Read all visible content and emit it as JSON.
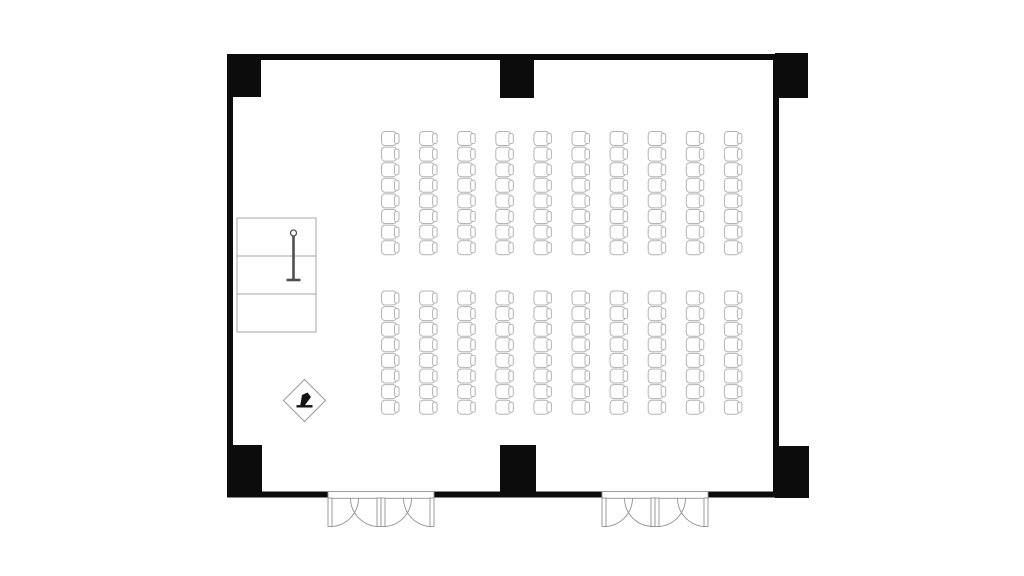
{
  "plan_type": "meeting-room-theater-style-floor-plan",
  "colors": {
    "background": "#ffffff",
    "wall": "#0c0c0c",
    "chair_outline": "#b4b4b4",
    "table_outline": "#a6a6a6",
    "door_outline": "#929292",
    "stand_stroke": "#4f4f4f",
    "symbol_outline": "#9a9a9a",
    "symbol_glyph": "#151515",
    "fill_white": "#ffffff"
  },
  "plan": {
    "room": {
      "x": 227,
      "y": 54,
      "w": 552,
      "h": 443.5,
      "wall_thickness": 6
    },
    "pillars": [
      {
        "id": "pillar-top-left",
        "x": 227,
        "y": 54,
        "w": 34,
        "h": 43
      },
      {
        "id": "pillar-top-middle",
        "x": 500,
        "y": 54,
        "w": 34,
        "h": 44
      },
      {
        "id": "pillar-top-right",
        "x": 775,
        "y": 53,
        "w": 33,
        "h": 45
      },
      {
        "id": "pillar-bottom-left",
        "x": 227,
        "y": 445,
        "w": 35,
        "h": 52.5
      },
      {
        "id": "pillar-bottom-middle",
        "x": 500,
        "y": 445,
        "w": 36,
        "h": 52.5
      },
      {
        "id": "pillar-bottom-right",
        "x": 775,
        "y": 446,
        "w": 34,
        "h": 52
      }
    ],
    "seating": {
      "facing": "left",
      "chair": {
        "seat_w": 15,
        "seat_h": 14,
        "back_w": 4.5,
        "back_h": 10,
        "back_overlap": 2
      },
      "blocks": [
        {
          "id": "seating-block-front",
          "x": 381.5,
          "y": 131.5,
          "cols": 10,
          "rows": 8,
          "dx": 38.1,
          "dy": 15.6
        },
        {
          "id": "seating-block-rear",
          "x": 381.5,
          "y": 291,
          "cols": 10,
          "rows": 8,
          "dx": 38.1,
          "dy": 15.6
        }
      ],
      "chairs_per_block": 80,
      "total_chairs": 160
    },
    "furniture": {
      "head_table": {
        "x": 237,
        "y": 218,
        "w": 79,
        "h": 114,
        "sections": 3
      },
      "screen_stand": {
        "cx": 293.5,
        "top": 230,
        "bottom": 280,
        "base_w": 14,
        "knob_r": 3
      },
      "projector_symbol": {
        "cx": 304.5,
        "cy": 400.5,
        "r": 21
      }
    },
    "entrances": [
      {
        "id": "entrance-left",
        "x": 328,
        "w": 106,
        "leaf_len": 28.5,
        "leaf_w": 4,
        "leaves": 4
      },
      {
        "id": "entrance-right",
        "x": 602,
        "w": 106,
        "leaf_len": 28.5,
        "leaf_w": 4,
        "leaves": 4
      }
    ]
  }
}
